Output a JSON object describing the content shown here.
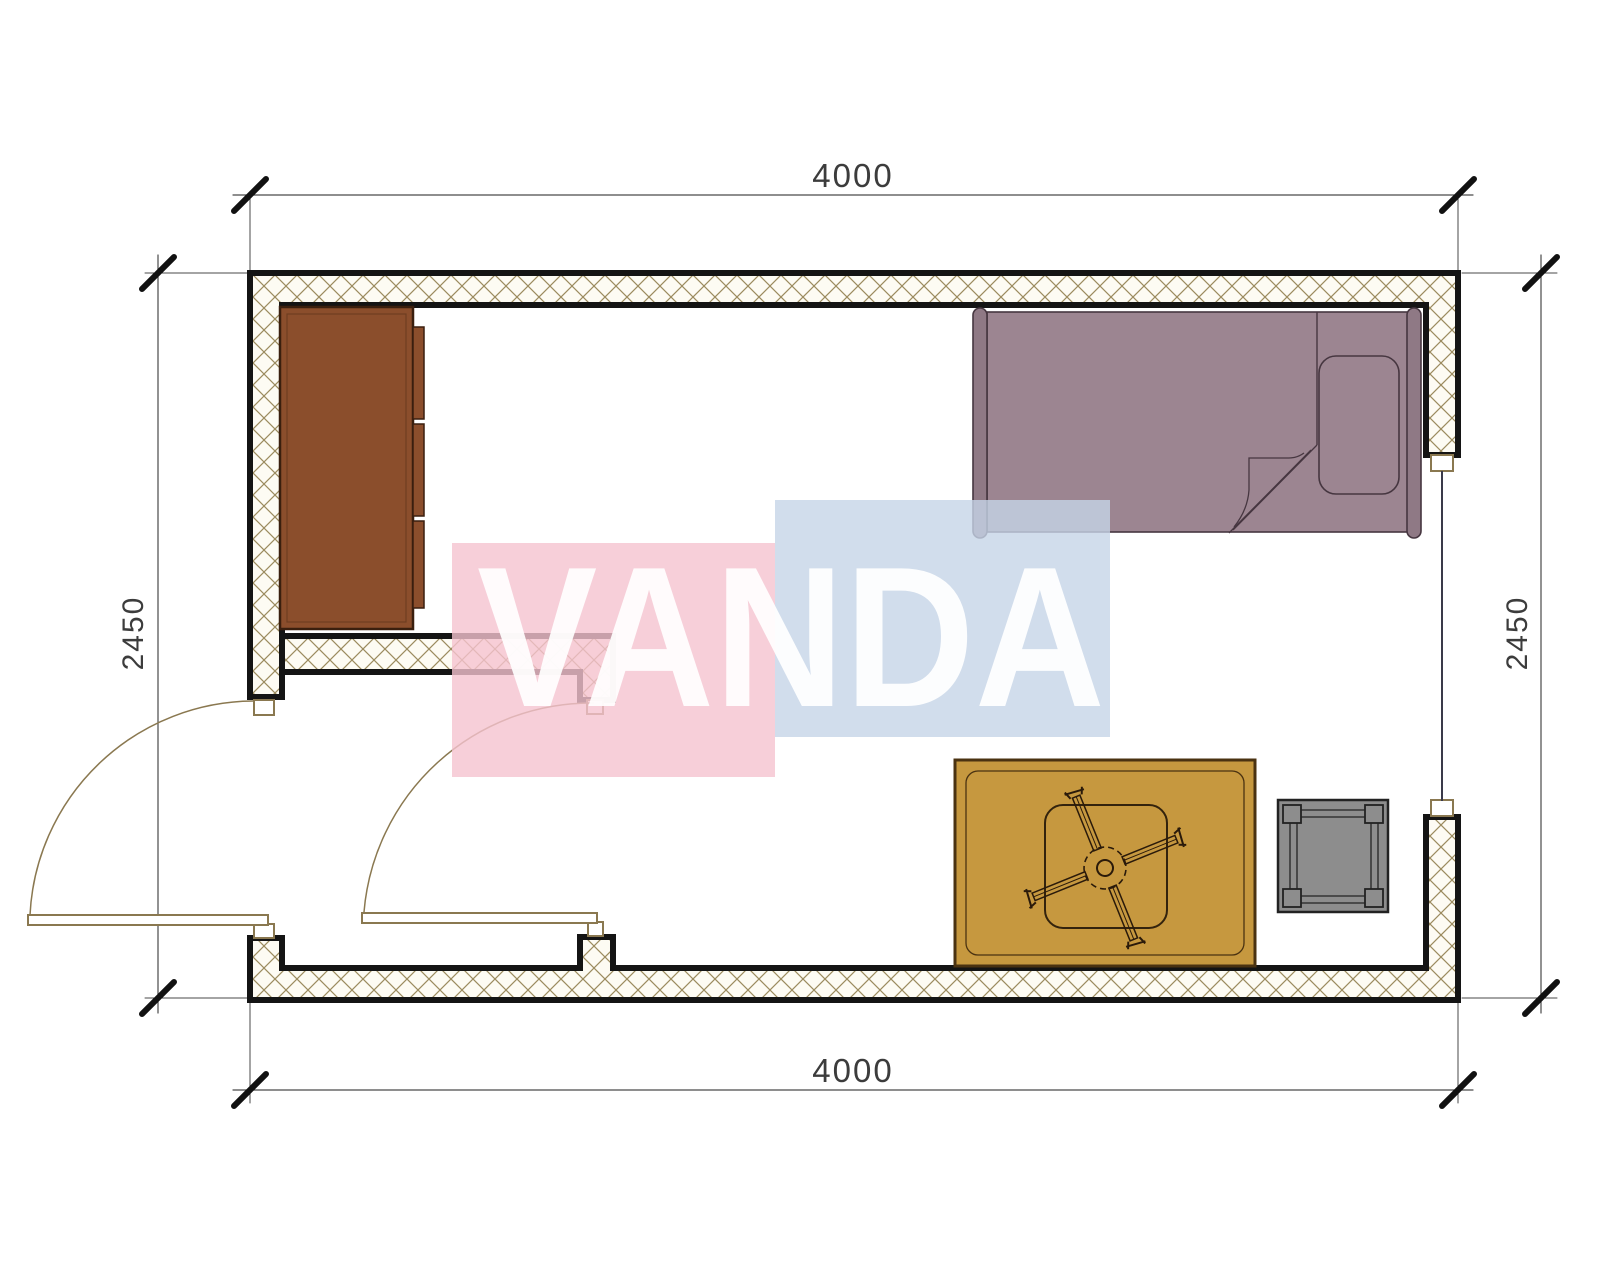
{
  "page": {
    "title": "Room floor plan",
    "background": "#FFFFFF"
  },
  "dimensions": {
    "top": "4000",
    "bottom": "4000",
    "left": "2450",
    "right": "2450"
  },
  "watermark": {
    "text": "VANDA",
    "pink_color": "#F5C3CF",
    "blue_color": "#C5D4E7",
    "text_color": "#FFFFFF"
  },
  "plan": {
    "wall_outline_color": "#141414",
    "hatch_line_color": "#9B8B5E",
    "hatch_bg_color": "#FDFBF3",
    "door_line_color": "#8A7850",
    "window_line_color": "#3A3A4A",
    "dimension_line_color": "#4A4A4A",
    "dimension_tick_color": "#111111",
    "furniture": {
      "dresser_color": "#8B4E2C",
      "dresser_outline_color": "#3A1F0E",
      "bed_color": "#9C8591",
      "bed_outline_color": "#463640",
      "rug_color": "#C6983F",
      "rug_outline_color": "#4A3211",
      "table_outline_color": "#33230D",
      "fan_line_color": "#2A1A0A",
      "stool_color": "#8D8D8D",
      "stool_outline_color": "#222222"
    }
  }
}
